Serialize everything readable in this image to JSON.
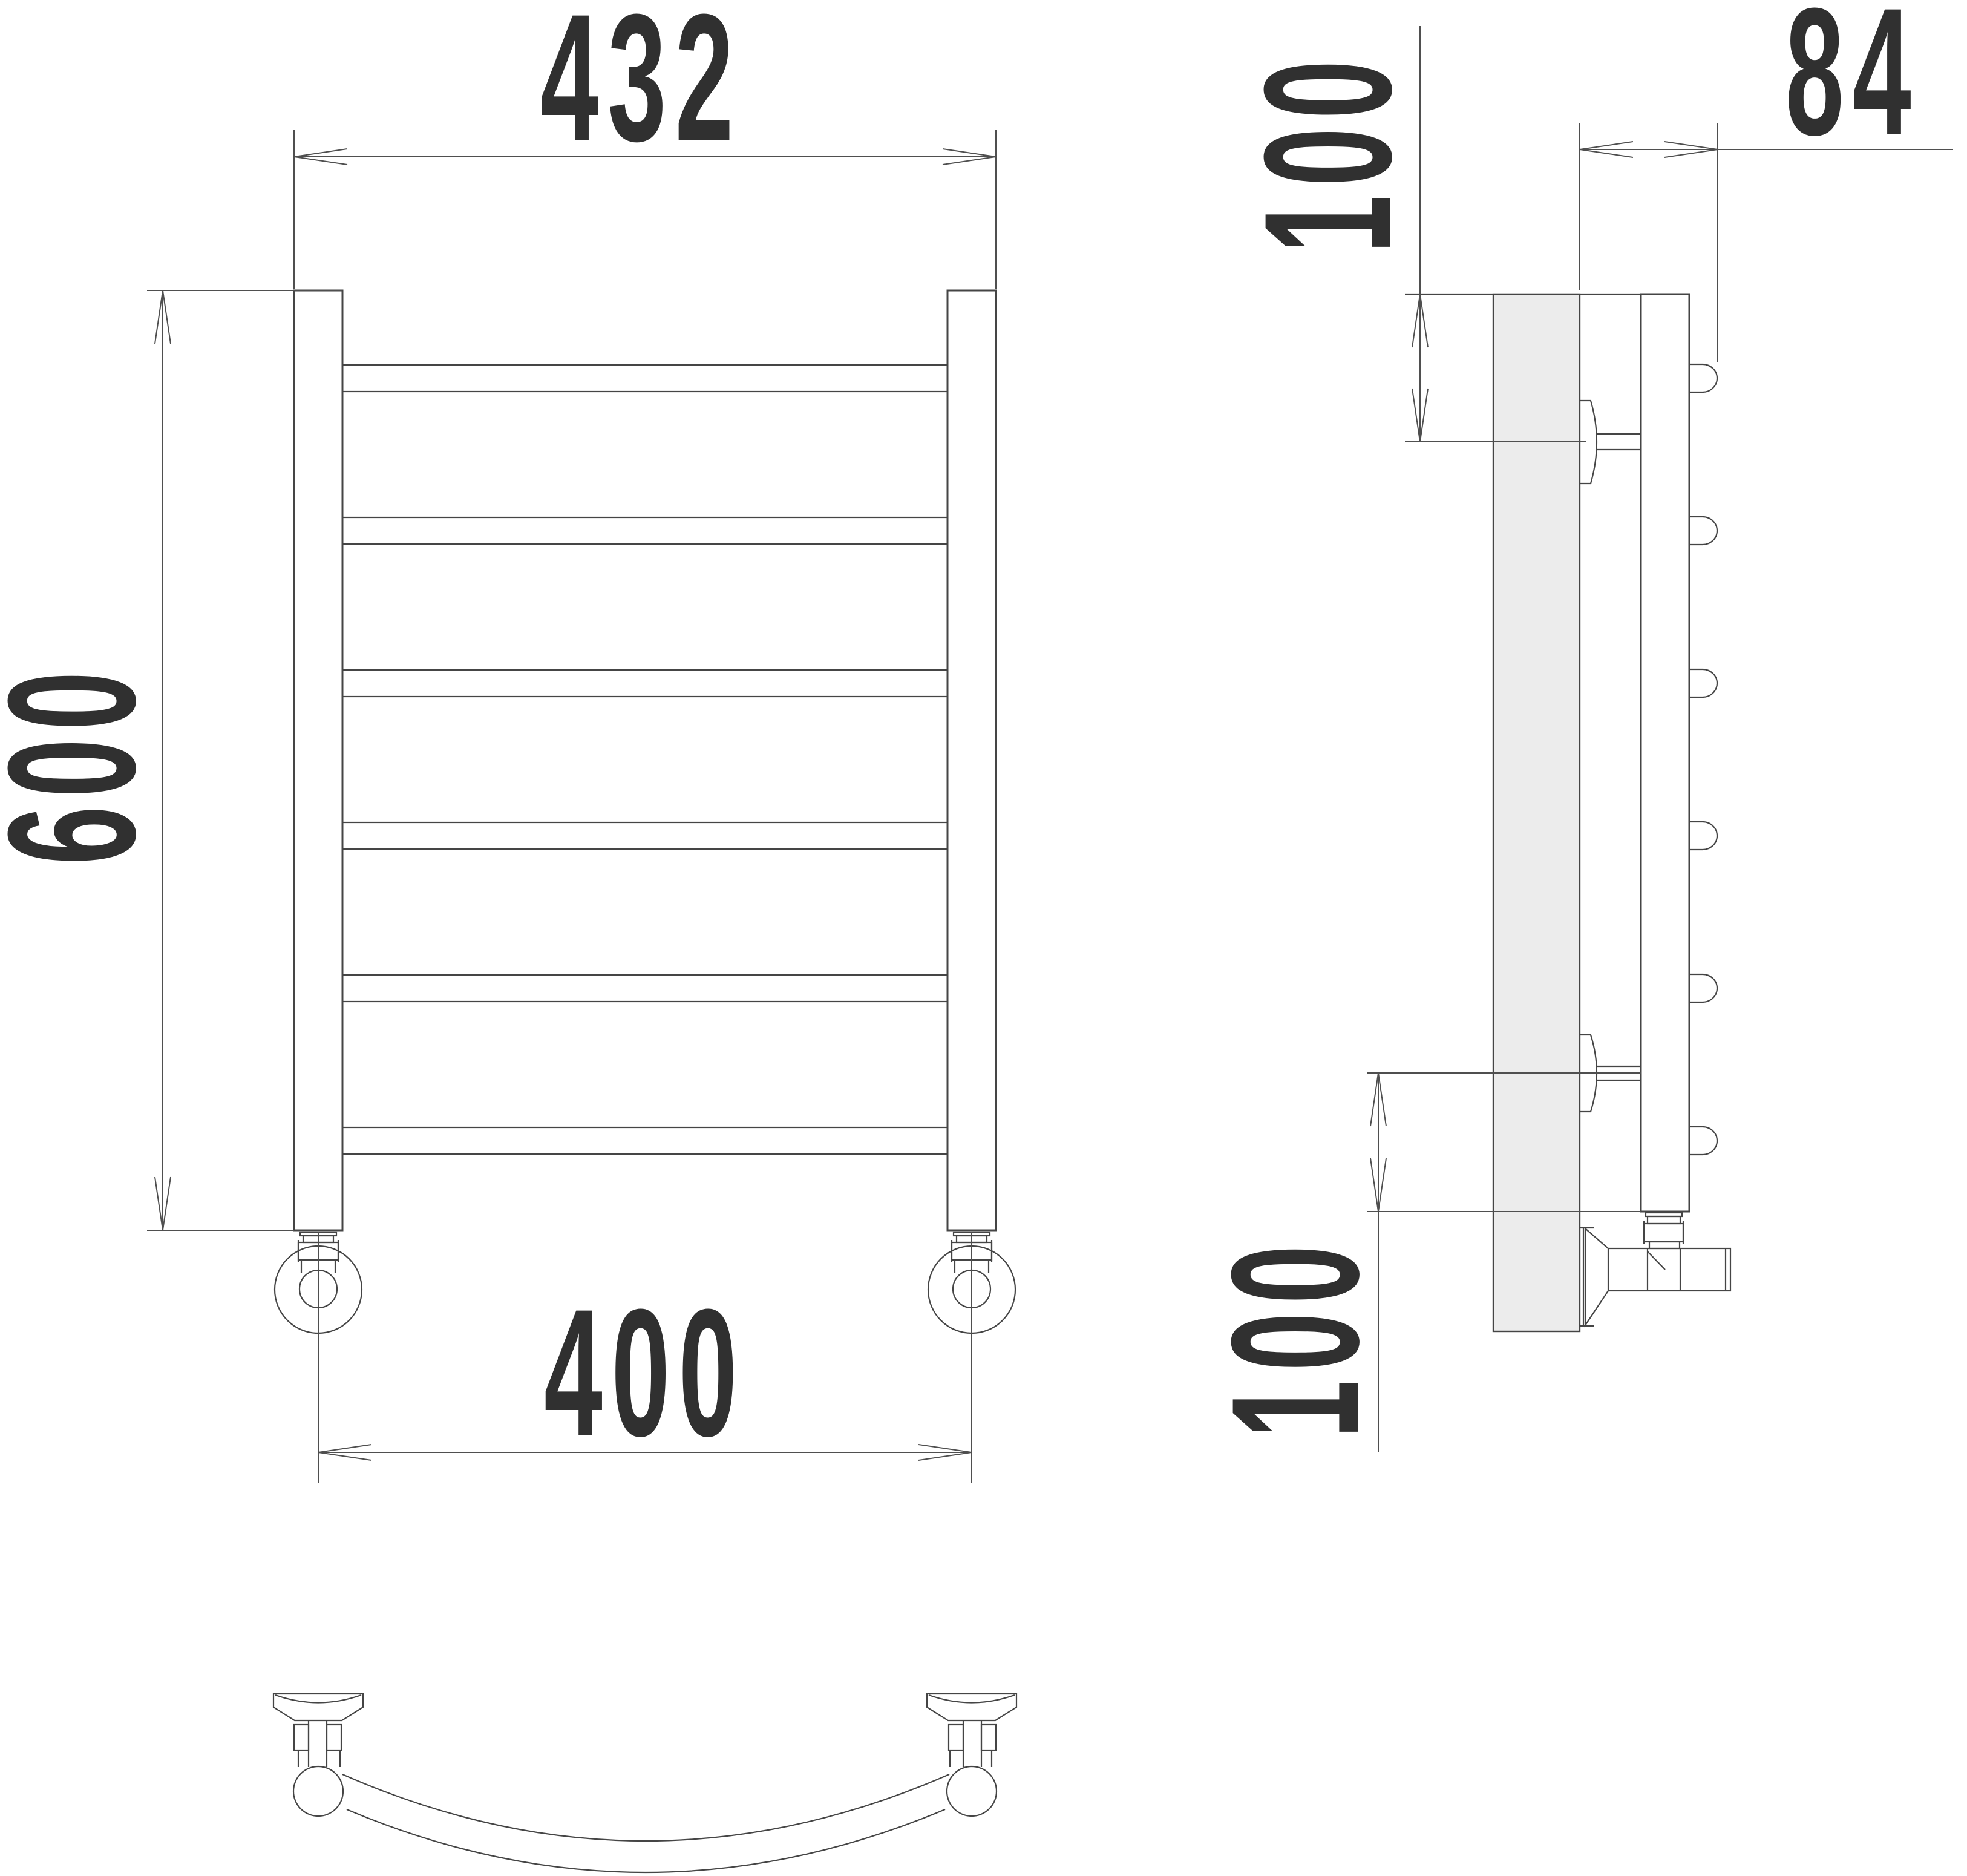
{
  "dimensions": {
    "front": {
      "overall_width": "432",
      "overall_height": "600",
      "pipe_spacing": "400"
    },
    "side": {
      "top_bracket_offset": "100",
      "depth": "84",
      "bottom_outlet_offset": "100"
    }
  },
  "colors": {
    "line": "#454545",
    "dim_line": "#4f4f4f",
    "text": "#303030",
    "wall_fill": "#ececec",
    "background": "#ffffff"
  }
}
